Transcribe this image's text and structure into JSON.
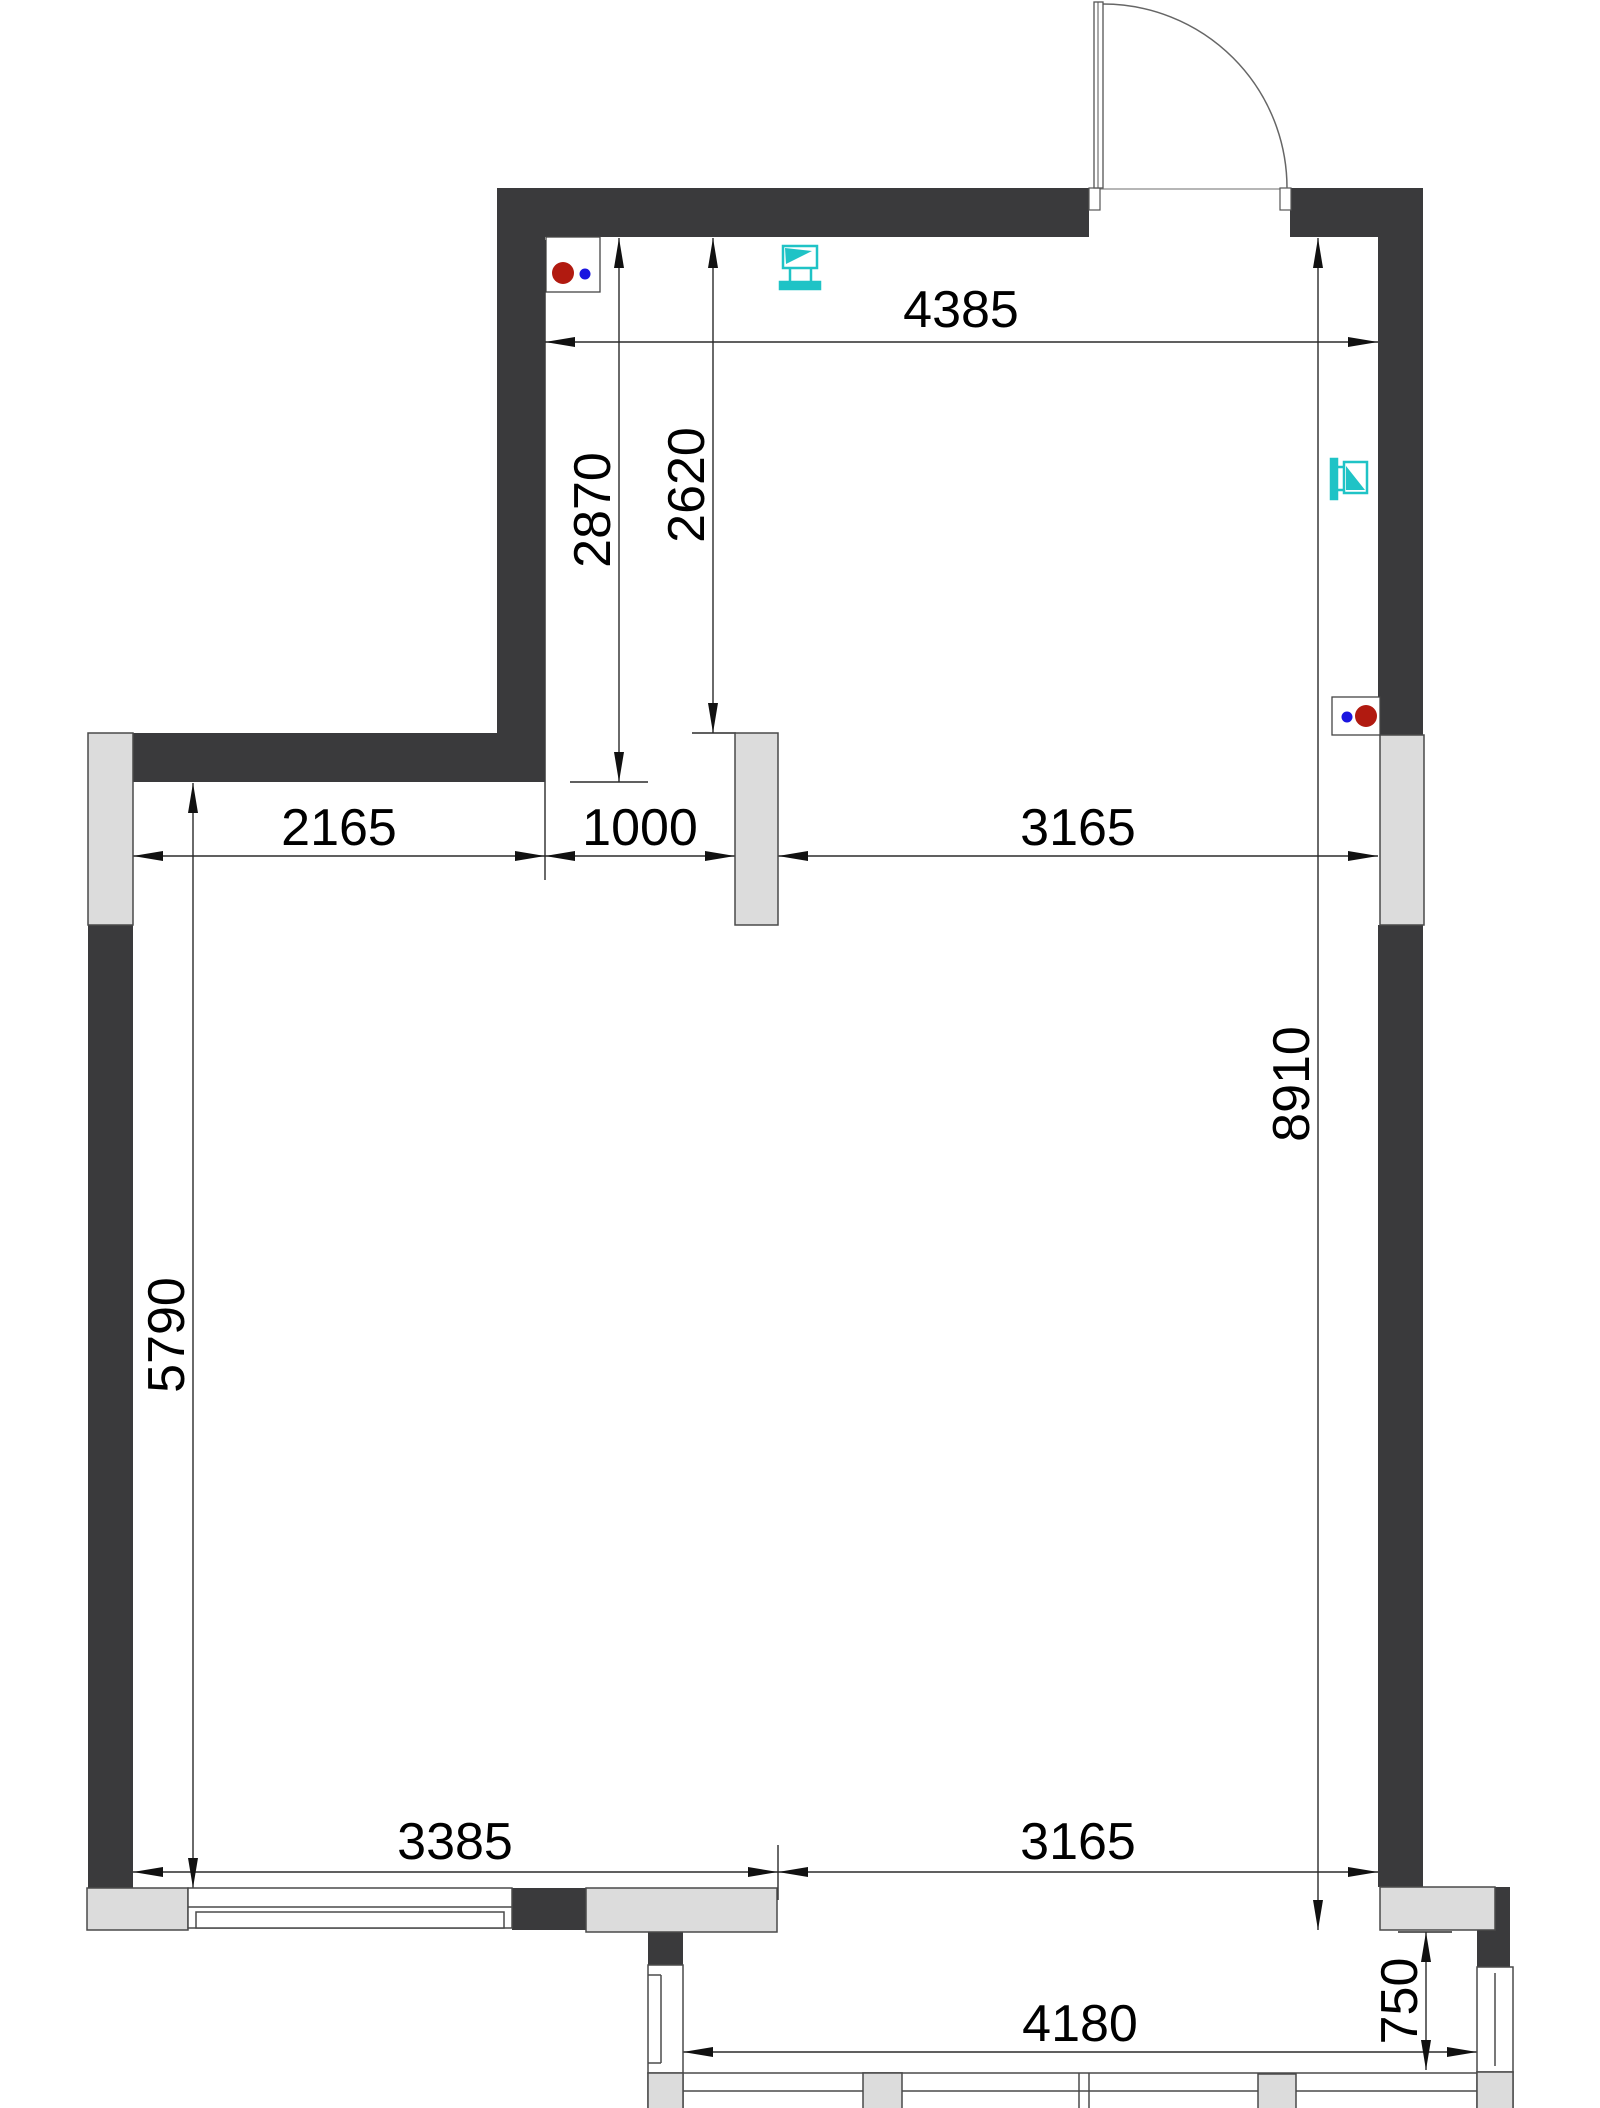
{
  "drawing": {
    "kind": "floor-plan",
    "colors": {
      "wall": "#3a3a3c",
      "opening_block": "#dcdcdc",
      "outline": "#4a4a4a",
      "dimension_line": "#2b2b2b",
      "fixture_cyan": "#1fc3c6",
      "socket_red": "#b11a10",
      "socket_blue": "#1a15e0"
    },
    "icons": {
      "door": "door-swing-icon",
      "tv_top_wall": "tv-icon",
      "tv_right_wall": "tv-icon",
      "socket_top_left": "socket-icon",
      "socket_right": "socket-icon",
      "windows": "window-icon"
    }
  },
  "dimensions": [
    {
      "value": "4385",
      "orientation": "horizontal",
      "location": "top-room-width"
    },
    {
      "value": "2870",
      "orientation": "vertical",
      "location": "top-room-depth-to-inner-face"
    },
    {
      "value": "2620",
      "orientation": "vertical",
      "location": "top-room-depth-to-wall-top"
    },
    {
      "value": "2165",
      "orientation": "horizontal",
      "location": "main-room-upper-left-segment"
    },
    {
      "value": "1000",
      "orientation": "horizontal",
      "location": "upper-opening-to-stub"
    },
    {
      "value": "3165",
      "orientation": "horizontal",
      "location": "upper-stub-to-right-wall"
    },
    {
      "value": "5790",
      "orientation": "vertical",
      "location": "main-room-left-height"
    },
    {
      "value": "8910",
      "orientation": "vertical",
      "location": "main-room-right-height"
    },
    {
      "value": "3385",
      "orientation": "horizontal",
      "location": "bottom-window-wall"
    },
    {
      "value": "3165",
      "orientation": "horizontal",
      "location": "bottom-opening"
    },
    {
      "value": "4180",
      "orientation": "horizontal",
      "location": "lower-room-width"
    },
    {
      "value": "750",
      "orientation": "vertical",
      "location": "lower-room-depth"
    }
  ]
}
